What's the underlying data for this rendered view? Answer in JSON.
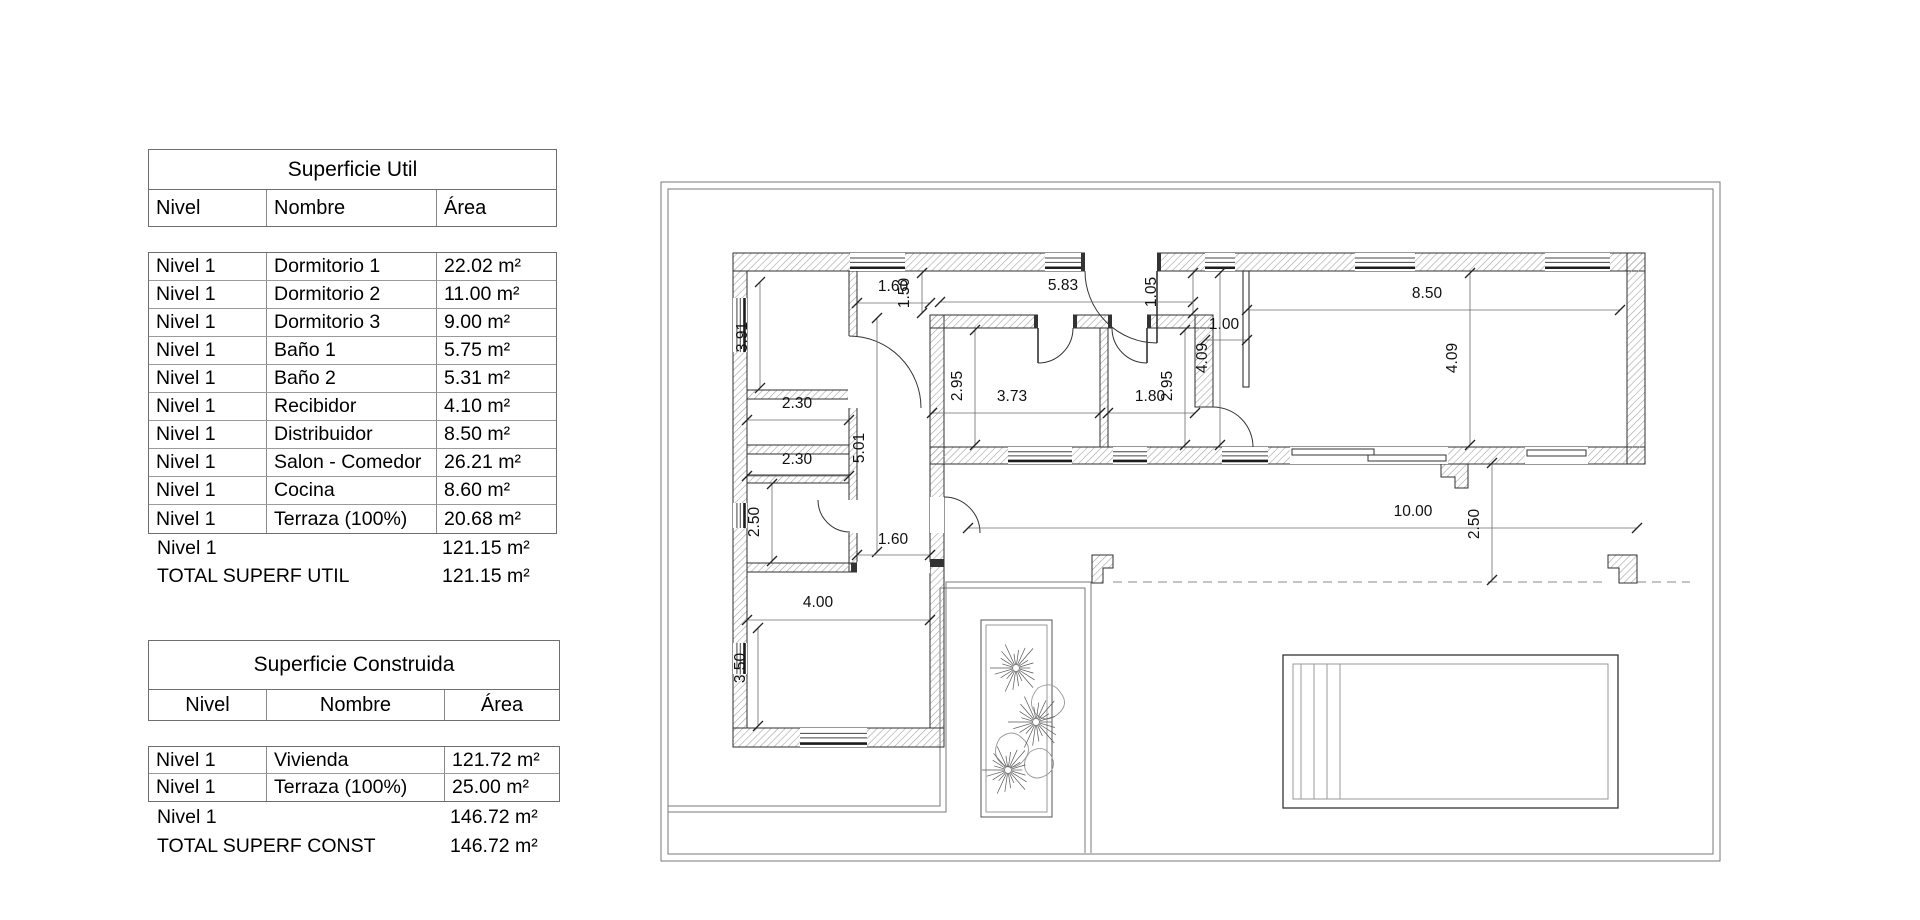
{
  "tables": {
    "util": {
      "title": "Superficie Util",
      "columns": [
        "Nivel",
        "Nombre",
        "Área"
      ],
      "rows": [
        [
          "Nivel 1",
          "Dormitorio 1",
          "22.02 m²"
        ],
        [
          "Nivel 1",
          "Dormitorio 2",
          "11.00 m²"
        ],
        [
          "Nivel 1",
          "Dormitorio 3",
          "9.00 m²"
        ],
        [
          "Nivel 1",
          "Baño 1",
          "5.75 m²"
        ],
        [
          "Nivel 1",
          "Baño 2",
          "5.31 m²"
        ],
        [
          "Nivel 1",
          "Recibidor",
          "4.10 m²"
        ],
        [
          "Nivel 1",
          "Distribuidor",
          "8.50 m²"
        ],
        [
          "Nivel 1",
          "Salon - Comedor",
          "26.21 m²"
        ],
        [
          "Nivel 1",
          "Cocina",
          "8.60 m²"
        ],
        [
          "Nivel 1",
          "Terraza (100%)",
          "20.68 m²"
        ]
      ],
      "subtotal": {
        "label": "Nivel 1",
        "value": "121.15 m²"
      },
      "total": {
        "label": "TOTAL SUPERF UTIL",
        "value": "121.15 m²"
      }
    },
    "construida": {
      "title": "Superficie Construida",
      "columns": [
        "Nivel",
        "Nombre",
        "Área"
      ],
      "rows": [
        [
          "Nivel 1",
          "Vivienda",
          "121.72 m²"
        ],
        [
          "Nivel 1",
          "Terraza (100%)",
          "25.00 m²"
        ]
      ],
      "subtotal": {
        "label": "Nivel 1",
        "value": "146.72 m²"
      },
      "total": {
        "label": "TOTAL SUPERF CONST",
        "value": "146.72 m²"
      }
    }
  },
  "plan": {
    "dimensions": [
      {
        "v": "1.60",
        "x1": 857,
        "y1": 303,
        "x2": 930,
        "y2": 303,
        "lx": 893,
        "ly": 291,
        "rot": 0
      },
      {
        "v": "1.50",
        "x1": 922,
        "y1": 273,
        "x2": 922,
        "y2": 313,
        "lx": 909,
        "ly": 293,
        "rot": 1
      },
      {
        "v": "5.83",
        "x1": 940,
        "y1": 302,
        "x2": 1193,
        "y2": 302,
        "lx": 1063,
        "ly": 290,
        "rot": 0
      },
      {
        "v": "1.05",
        "x1": 1193,
        "y1": 273,
        "x2": 1193,
        "y2": 313,
        "lx": 1156,
        "ly": 292,
        "rot": 1
      },
      {
        "v": "1.00",
        "x1": 1205,
        "y1": 340,
        "x2": 1247,
        "y2": 340,
        "lx": 1224,
        "ly": 329,
        "rot": 0
      },
      {
        "v": "8.50",
        "x1": 1247,
        "y1": 310,
        "x2": 1620,
        "y2": 310,
        "lx": 1427,
        "ly": 298,
        "rot": 0
      },
      {
        "v": "4.09",
        "x1": 1220,
        "y1": 273,
        "x2": 1220,
        "y2": 445,
        "lx": 1207,
        "ly": 358,
        "rot": 1
      },
      {
        "v": "4.09",
        "x1": 1470,
        "y1": 273,
        "x2": 1470,
        "y2": 445,
        "lx": 1457,
        "ly": 358,
        "rot": 1
      },
      {
        "v": "2.95",
        "x1": 975,
        "y1": 330,
        "x2": 975,
        "y2": 445,
        "lx": 962,
        "ly": 386,
        "rot": 1
      },
      {
        "v": "3.73",
        "x1": 932,
        "y1": 413,
        "x2": 1100,
        "y2": 413,
        "lx": 1012,
        "ly": 401,
        "rot": 0
      },
      {
        "v": "2.95",
        "x1": 1185,
        "y1": 330,
        "x2": 1185,
        "y2": 445,
        "lx": 1172,
        "ly": 386,
        "rot": 1
      },
      {
        "v": "1.80",
        "x1": 1108,
        "y1": 413,
        "x2": 1195,
        "y2": 413,
        "lx": 1150,
        "ly": 401,
        "rot": 0
      },
      {
        "v": "3.91",
        "x1": 760,
        "y1": 282,
        "x2": 760,
        "y2": 388,
        "lx": 747,
        "ly": 337,
        "rot": 1
      },
      {
        "v": "2.30",
        "x1": 747,
        "y1": 420,
        "x2": 849,
        "y2": 420,
        "lx": 797,
        "ly": 408,
        "rot": 0
      },
      {
        "v": "2.30",
        "x1": 747,
        "y1": 476,
        "x2": 849,
        "y2": 476,
        "lx": 797,
        "ly": 464,
        "rot": 0
      },
      {
        "v": "2.50",
        "x1": 772,
        "y1": 484,
        "x2": 772,
        "y2": 561,
        "lx": 759,
        "ly": 522,
        "rot": 1
      },
      {
        "v": "5.01",
        "x1": 877,
        "y1": 318,
        "x2": 877,
        "y2": 552,
        "lx": 864,
        "ly": 448,
        "rot": 1
      },
      {
        "v": "1.60",
        "x1": 857,
        "y1": 555,
        "x2": 930,
        "y2": 555,
        "lx": 893,
        "ly": 544,
        "rot": 0
      },
      {
        "v": "4.00",
        "x1": 747,
        "y1": 620,
        "x2": 930,
        "y2": 620,
        "lx": 818,
        "ly": 607,
        "rot": 0
      },
      {
        "v": "3.50",
        "x1": 758,
        "y1": 628,
        "x2": 758,
        "y2": 726,
        "lx": 745,
        "ly": 668,
        "rot": 1
      },
      {
        "v": "10.00",
        "x1": 968,
        "y1": 528,
        "x2": 1637,
        "y2": 528,
        "lx": 1413,
        "ly": 516,
        "rot": 0
      },
      {
        "v": "2.50",
        "x1": 1492,
        "y1": 463,
        "x2": 1492,
        "y2": 580,
        "lx": 1479,
        "ly": 524,
        "rot": 1
      }
    ]
  }
}
